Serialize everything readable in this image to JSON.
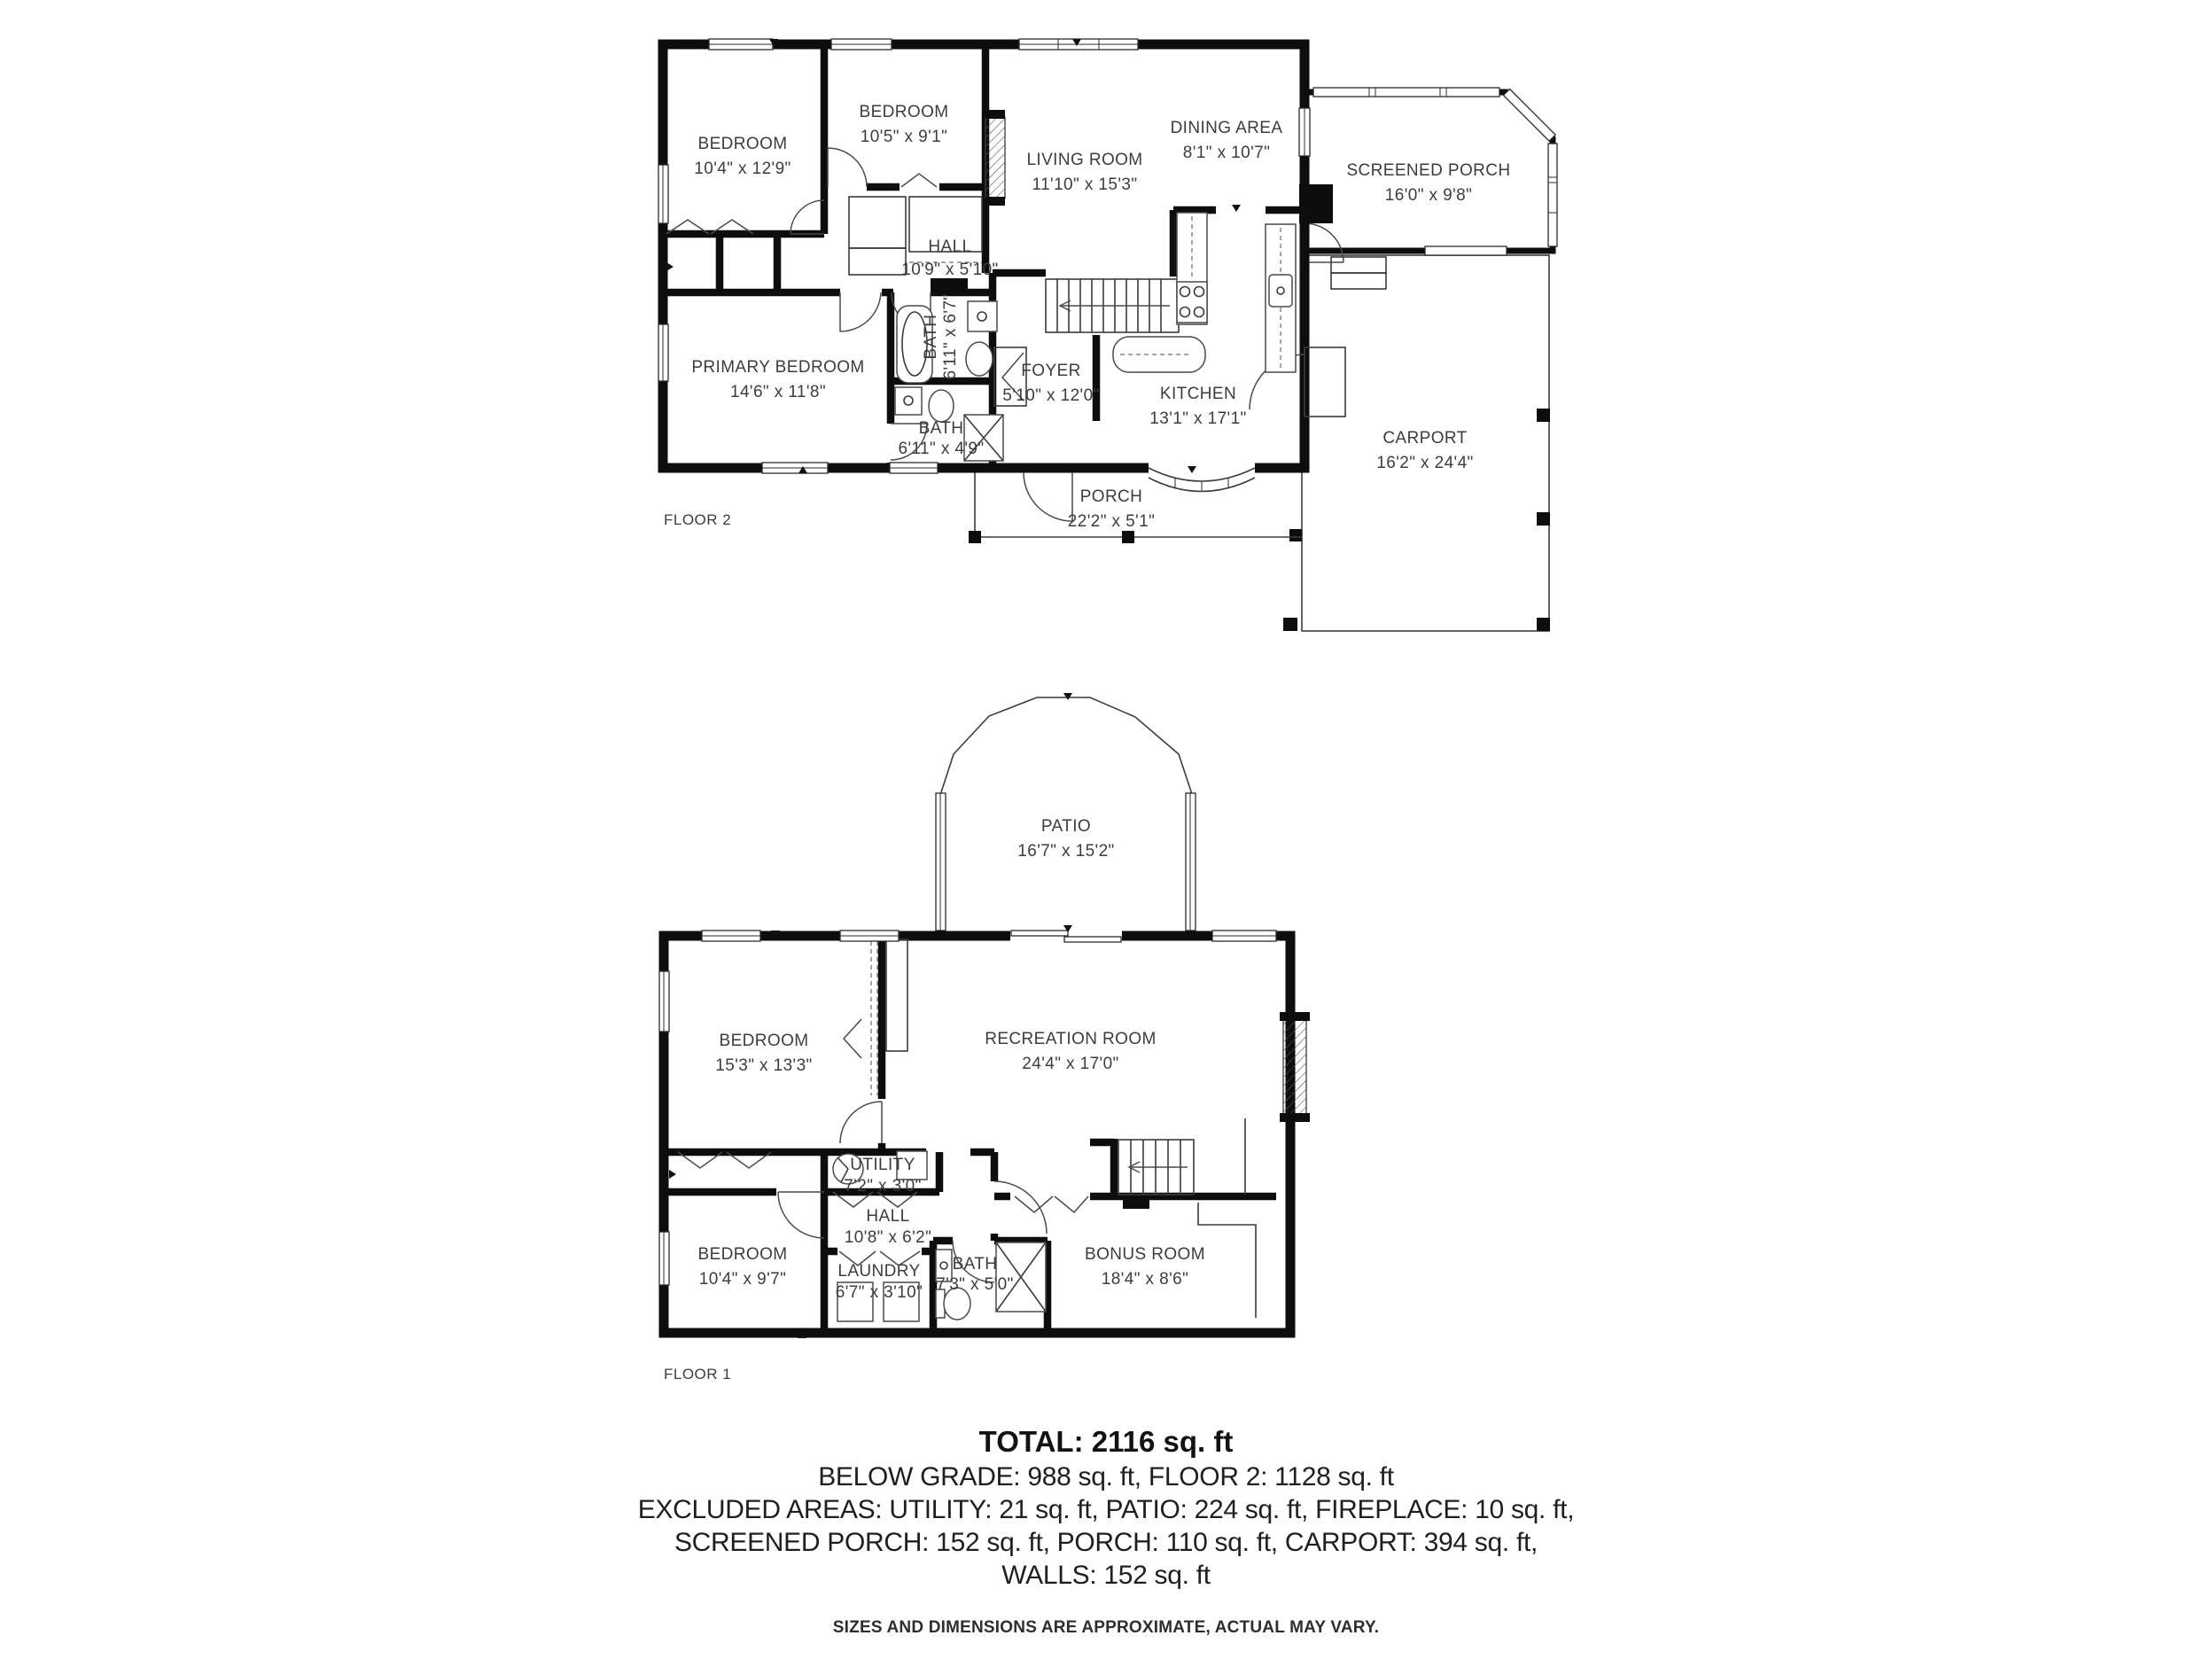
{
  "floor2": {
    "label": "FLOOR 2",
    "rooms": [
      {
        "name": "BEDROOM",
        "dims": "10'4\" x 12'9\""
      },
      {
        "name": "BEDROOM",
        "dims": "10'5\" x 9'1\""
      },
      {
        "name": "LIVING ROOM",
        "dims": "11'10\" x 15'3\""
      },
      {
        "name": "DINING AREA",
        "dims": "8'1\" x 10'7\""
      },
      {
        "name": "SCREENED PORCH",
        "dims": "16'0\" x 9'8\""
      },
      {
        "name": "HALL",
        "dims": "10'9\" x 5'10\""
      },
      {
        "name": "BATH",
        "dims": "6'11\" x 6'7\""
      },
      {
        "name": "PRIMARY BEDROOM",
        "dims": "14'6\" x 11'8\""
      },
      {
        "name": "FOYER",
        "dims": "5'10\" x 12'0\""
      },
      {
        "name": "KITCHEN",
        "dims": "13'1\" x 17'1\""
      },
      {
        "name": "BATH",
        "dims": "6'11\" x 4'9\""
      },
      {
        "name": "CARPORT",
        "dims": "16'2\" x 24'4\""
      },
      {
        "name": "PORCH",
        "dims": "22'2\" x 5'1\""
      }
    ]
  },
  "floor1": {
    "label": "FLOOR 1",
    "rooms": [
      {
        "name": "PATIO",
        "dims": "16'7\" x 15'2\""
      },
      {
        "name": "BEDROOM",
        "dims": "15'3\" x 13'3\""
      },
      {
        "name": "RECREATION ROOM",
        "dims": "24'4\" x 17'0\""
      },
      {
        "name": "UTILITY",
        "dims": "7'2\" x 3'0\""
      },
      {
        "name": "HALL",
        "dims": "10'8\" x 6'2\""
      },
      {
        "name": "BEDROOM",
        "dims": "10'4\" x 9'7\""
      },
      {
        "name": "LAUNDRY",
        "dims": "6'7\" x 3'10\""
      },
      {
        "name": "BATH",
        "dims": "7'3\" x 5'0\""
      },
      {
        "name": "BONUS ROOM",
        "dims": "18'4\" x 8'6\""
      }
    ]
  },
  "summary": {
    "total": "TOTAL: 2116 sq. ft",
    "line1": "BELOW GRADE: 988 sq. ft, FLOOR 2: 1128 sq. ft",
    "line2": "EXCLUDED AREAS: UTILITY: 21 sq. ft, PATIO: 224 sq. ft, FIREPLACE: 10 sq. ft,",
    "line3": "SCREENED PORCH: 152 sq. ft, PORCH: 110 sq. ft, CARPORT: 394 sq. ft,",
    "line4": "WALLS: 152 sq. ft",
    "disclaimer": "SIZES AND DIMENSIONS ARE APPROXIMATE, ACTUAL MAY VARY."
  },
  "colors": {
    "wall": "#0d0d0d",
    "text": "#3d3d3d",
    "background": "#ffffff"
  }
}
